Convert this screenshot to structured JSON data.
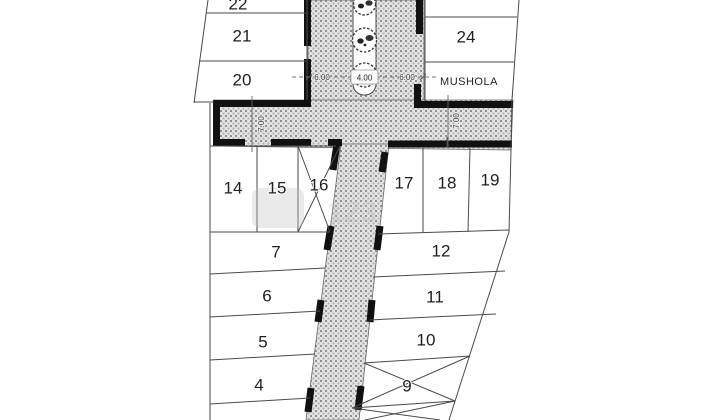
{
  "plan": {
    "title_hint": "site-plan-drawing",
    "plots": {
      "p22": "22",
      "p21": "21",
      "p20": "20",
      "p24": "24",
      "mushola": "MUSHOLA",
      "p14": "14",
      "p15": "15",
      "p16": "16",
      "p17": "17",
      "p18": "18",
      "p19": "19",
      "p7": "7",
      "p12": "12",
      "p6": "6",
      "p11": "11",
      "p5": "5",
      "p10": "10",
      "p4": "4",
      "p9": "9"
    },
    "dimensions": {
      "lane_left": "6.00",
      "median": "4.00",
      "lane_right": "6.00",
      "cross_road_left": "7.00",
      "cross_road_right": "7.00"
    },
    "watermark": "123"
  },
  "colors": {
    "line": "#4a4a4a",
    "wall": "#111111",
    "hatch_base": "#e4e4e4",
    "hatch_dot": "#909090",
    "label": "#1f1f1f",
    "dimension": "#3a3a3a",
    "watermark": "#c4c4c4"
  }
}
